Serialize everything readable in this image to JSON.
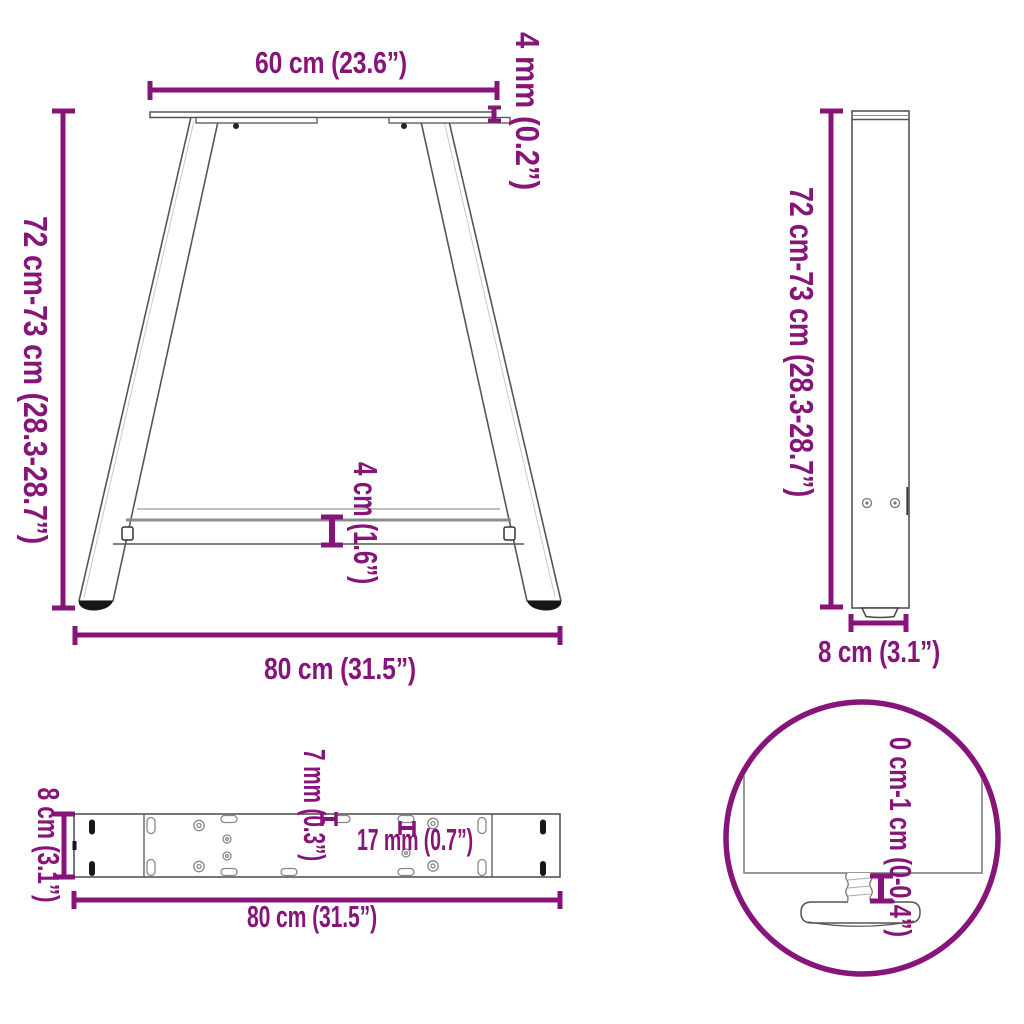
{
  "colors": {
    "accent": "#871478",
    "line": "#555555",
    "light_line": "#8c8c8c",
    "dark_fill": "#161616"
  },
  "views": {
    "front": {
      "name": "a-shaped-table-leg-front-view",
      "labels": {
        "top_width": "60 cm (23.6”)",
        "plate_thickness": "4 mm (0.2”)",
        "height": "72 cm-73 cm (28.3-28.7”)",
        "crossbar_height": "4 cm (1.6”)",
        "base_width": "80 cm (31.5”)"
      }
    },
    "side": {
      "name": "table-leg-side-profile-view",
      "labels": {
        "height": "72 cm-73 cm (28.3-28.7”)",
        "depth": "8 cm (3.1”)"
      }
    },
    "crossbar_top": {
      "name": "crossbar-top-view",
      "labels": {
        "width": "8 cm (3.1”)",
        "slot_width": "7 mm (0.3”)",
        "slot_length": "17 mm (0.7”)",
        "length": "80 cm (31.5”)"
      }
    },
    "foot_detail": {
      "name": "adjustable-foot-detail-zoom",
      "labels": {
        "adjust_range": "0 cm-1 cm (0-0.4”)"
      }
    }
  }
}
